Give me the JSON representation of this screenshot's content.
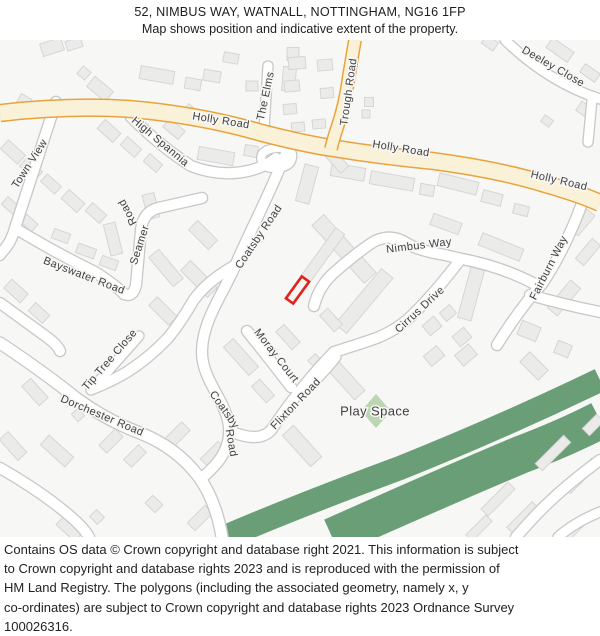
{
  "header": {
    "title": "52, NIMBUS WAY, WATNALL, NOTTINGHAM, NG16 1FP",
    "subtitle": "Map shows position and indicative extent of the property."
  },
  "footer": {
    "lines": [
      "Contains OS data © Crown copyright and database right 2021. This information is subject",
      "to Crown copyright and database rights 2023 and is reproduced with the permission of",
      "HM Land Registry. The polygons (including the associated geometry, namely x, y",
      "co-ordinates) are subject to Crown copyright and database rights 2023 Ordnance Survey",
      "100026316."
    ]
  },
  "map": {
    "colors": {
      "background": "#f7f7f6",
      "building_fill": "#ebebea",
      "building_stroke": "#d7d6d4",
      "road_casing": "#c8c8c6",
      "road_fill": "#ffffff",
      "main_road_casing": "#e8a33c",
      "main_road_fill": "#faf2d8",
      "green": "#699e77",
      "play_space_fill": "#bcd5b3",
      "label_color": "#3f3f3f",
      "plot_red": "#e32219"
    },
    "green": {
      "ribbons": [
        {
          "d": "M 225,537 Q 300,505 400,468 Q 500,428 600,380",
          "width": 24
        },
        {
          "d": "M 332,537 Q 430,493 520,455 Q 565,438 600,420",
          "width": 38
        }
      ],
      "play_space": {
        "label": "Play Space",
        "cx": 376,
        "cy": 411,
        "rx": 15,
        "ry": 17
      }
    },
    "white_roads": [
      {
        "name": "town-view",
        "d": "M 56,102 L 15,228 Q 11,243 2,252 L 0,255",
        "w": 10
      },
      {
        "name": "bayswater-road",
        "d": "M 18,230 Q 60,255 95,272 Q 118,287 124,294",
        "w": 10
      },
      {
        "name": "seamer-road",
        "d": "M 124,294 Q 133,298 136,285 L 141,230 Q 143,212 158,208 L 202,198",
        "w": 10
      },
      {
        "name": "coatsby-road",
        "d": "M 291,141 C 272,190 249,233 235,266 C 223,294 203,320 202,350 C 201,380 226,399 229,427 C 231,453 213,468 202,478",
        "w": 10
      },
      {
        "name": "the-elms",
        "d": "M 268,66 L 264,129",
        "w": 9
      },
      {
        "name": "deeley-close",
        "d": "M 505,40 Q 548,82 600,99",
        "w": 9
      },
      {
        "name": "deeley-spur",
        "d": "M 592,100 L 588,142",
        "w": 9
      },
      {
        "name": "fairburn-way",
        "d": "M 584,198 Q 566,248 542,284 Q 520,308 497,345",
        "w": 10
      },
      {
        "name": "fairburn-east",
        "d": "M 530,295 Q 565,305 600,312",
        "w": 10
      },
      {
        "name": "nimbus-way",
        "d": "M 314,306 Q 319,285 336,271 Q 360,250 375,241 Q 392,233 408,244 Q 420,251 445,255 L 462,259 Q 500,266 535,284",
        "w": 10
      },
      {
        "name": "cirrus-drive",
        "d": "M 460,260 Q 432,297 406,321 Q 388,335 368,341 Q 350,347 334,352",
        "w": 10
      },
      {
        "name": "flixton-road",
        "d": "M 334,352 Q 310,377 292,401 Q 280,417 272,429 Q 260,444 230,431",
        "w": 10
      },
      {
        "name": "moray-court",
        "d": "M 247,331 Q 272,362 291,387",
        "w": 10
      },
      {
        "name": "moray-stub",
        "d": "M 298,396 Q 320,378 336,357",
        "w": 9
      },
      {
        "name": "dorchester-road",
        "d": "M 0,343 Q 45,373 76,398 Q 106,420 140,433 Q 176,447 199,477 Q 216,501 222,537",
        "w": 11
      },
      {
        "name": "tip-tree-close",
        "d": "M 91,390 L 139,336",
        "w": 9
      },
      {
        "name": "mid-connector",
        "d": "M 234,266 Q 206,282 193,301 Q 181,322 168,338 Q 149,358 127,372 Q 110,382 92,389",
        "w": 10
      },
      {
        "name": "high-spannia",
        "d": "M 131,117 Q 160,146 191,166 Q 222,178 252,170 Q 268,165 276,158",
        "w": 10
      },
      {
        "name": "spannia-loop",
        "d": "M 262,162 Q 258,150 276,148 Q 294,147 292,158 Q 290,168 274,168 Q 264,168 262,162 Z",
        "w": 8
      },
      {
        "name": "sw-spur",
        "d": "M 0,303 L 44,335 Q 57,344 60,351",
        "w": 10
      },
      {
        "name": "sw-road",
        "d": "M 0,468 Q 42,492 70,516 Q 84,528 89,537",
        "w": 10
      },
      {
        "name": "br-road",
        "d": "M 600,460 Q 562,488 537,514 Q 523,529 516,537",
        "w": 10
      },
      {
        "name": "br-spur",
        "d": "M 600,512 Q 575,522 558,537",
        "w": 9
      }
    ],
    "yellow_roads": [
      {
        "name": "holly-road",
        "d": "M 0,113 Q 70,105 130,109 Q 200,115 262,133 Q 305,144 332,148 Q 380,156 433,161 Q 500,170 545,184 Q 580,194 600,203",
        "w": 15.5,
        "cw": 18.5
      },
      {
        "name": "trough-road",
        "d": "M 355,40 L 349,75 Q 345,105 337,128 Q 333,140 331,149",
        "w": 11,
        "cw": 14
      }
    ],
    "buildings": [
      [
        52,
        47,
        22,
        13,
        -18
      ],
      [
        74,
        44,
        16,
        10,
        -18
      ],
      [
        100,
        89,
        24,
        13,
        40
      ],
      [
        84,
        73,
        10,
        10,
        40
      ],
      [
        157,
        75,
        34,
        13,
        10
      ],
      [
        193,
        84,
        16,
        11,
        10
      ],
      [
        212,
        76,
        17,
        11,
        10
      ],
      [
        231,
        58,
        15,
        10,
        10
      ],
      [
        252,
        86,
        12,
        10,
        0
      ],
      [
        289,
        79,
        13,
        24,
        5
      ],
      [
        293,
        54,
        12,
        13,
        0
      ],
      [
        23,
        103,
        12,
        15,
        30
      ],
      [
        8,
        112,
        8,
        11,
        30
      ],
      [
        297,
        63,
        17,
        12,
        -5
      ],
      [
        292,
        86,
        15,
        11,
        -5
      ],
      [
        290,
        109,
        13,
        10,
        -5
      ],
      [
        298,
        127,
        13,
        9,
        -5
      ],
      [
        325,
        65,
        15,
        11,
        -5
      ],
      [
        327,
        93,
        13,
        10,
        -5
      ],
      [
        319,
        124,
        13,
        9,
        -5
      ],
      [
        369,
        102,
        9,
        9,
        0
      ],
      [
        366,
        114,
        8,
        8,
        0
      ],
      [
        560,
        50,
        26,
        12,
        35
      ],
      [
        590,
        73,
        18,
        10,
        35
      ],
      [
        490,
        43,
        14,
        10,
        35
      ],
      [
        585,
        110,
        15,
        11,
        35
      ],
      [
        547,
        121,
        10,
        8,
        35
      ],
      [
        348,
        172,
        34,
        13,
        10
      ],
      [
        392,
        181,
        44,
        13,
        10
      ],
      [
        427,
        190,
        14,
        11,
        10
      ],
      [
        458,
        184,
        40,
        13,
        14
      ],
      [
        492,
        198,
        20,
        12,
        14
      ],
      [
        521,
        210,
        15,
        10,
        14
      ],
      [
        582,
        222,
        26,
        12,
        -50
      ],
      [
        13,
        152,
        23,
        12,
        42
      ],
      [
        31,
        169,
        21,
        11,
        42
      ],
      [
        51,
        184,
        19,
        10,
        42
      ],
      [
        11,
        206,
        17,
        10,
        42
      ],
      [
        29,
        223,
        15,
        10,
        42
      ],
      [
        109,
        131,
        21,
        12,
        42
      ],
      [
        131,
        147,
        19,
        11,
        42
      ],
      [
        153,
        163,
        17,
        10,
        42
      ],
      [
        174,
        129,
        20,
        11,
        40
      ],
      [
        192,
        113,
        17,
        10,
        40
      ],
      [
        216,
        156,
        36,
        13,
        10
      ],
      [
        251,
        151,
        13,
        11,
        10
      ],
      [
        73,
        201,
        21,
        12,
        42
      ],
      [
        96,
        213,
        19,
        11,
        42
      ],
      [
        61,
        236,
        17,
        10,
        20
      ],
      [
        86,
        251,
        19,
        10,
        20
      ],
      [
        109,
        263,
        17,
        10,
        20
      ],
      [
        16,
        291,
        22,
        12,
        42
      ],
      [
        39,
        313,
        19,
        11,
        42
      ],
      [
        113,
        239,
        12,
        32,
        -14
      ],
      [
        151,
        206,
        12,
        25,
        -14
      ],
      [
        166,
        268,
        38,
        13,
        50
      ],
      [
        199,
        279,
        38,
        14,
        45
      ],
      [
        163,
        311,
        28,
        12,
        45
      ],
      [
        203,
        235,
        28,
        13,
        45
      ],
      [
        344,
        249,
        78,
        16,
        48
      ],
      [
        307,
        184,
        14,
        38,
        15
      ],
      [
        315,
        266,
        11,
        86,
        36
      ],
      [
        364,
        301,
        15,
        72,
        40
      ],
      [
        336,
        160,
        26,
        11,
        48
      ],
      [
        446,
        224,
        30,
        12,
        20
      ],
      [
        501,
        247,
        44,
        13,
        22
      ],
      [
        564,
        298,
        36,
        13,
        -50
      ],
      [
        588,
        252,
        26,
        11,
        -50
      ],
      [
        471,
        294,
        14,
        52,
        15
      ],
      [
        432,
        326,
        15,
        13,
        -40
      ],
      [
        448,
        313,
        13,
        11,
        -40
      ],
      [
        462,
        337,
        15,
        13,
        -40
      ],
      [
        434,
        356,
        17,
        13,
        -40
      ],
      [
        466,
        355,
        18,
        14,
        -40
      ],
      [
        529,
        331,
        20,
        15,
        22
      ],
      [
        563,
        349,
        15,
        13,
        22
      ],
      [
        534,
        366,
        26,
        14,
        45
      ],
      [
        241,
        357,
        38,
        13,
        48
      ],
      [
        288,
        337,
        24,
        11,
        48
      ],
      [
        331,
        320,
        22,
        11,
        48
      ],
      [
        263,
        391,
        22,
        11,
        48
      ],
      [
        302,
        446,
        42,
        15,
        48
      ],
      [
        347,
        381,
        38,
        14,
        48
      ],
      [
        317,
        363,
        16,
        10,
        48
      ],
      [
        13,
        446,
        28,
        12,
        48
      ],
      [
        57,
        451,
        33,
        13,
        42
      ],
      [
        69,
        529,
        25,
        11,
        42
      ],
      [
        111,
        441,
        23,
        11,
        -45
      ],
      [
        135,
        456,
        21,
        11,
        -45
      ],
      [
        176,
        436,
        28,
        12,
        -45
      ],
      [
        213,
        454,
        25,
        11,
        -45
      ],
      [
        200,
        518,
        25,
        11,
        -45
      ],
      [
        154,
        504,
        14,
        11,
        45
      ],
      [
        97,
        517,
        11,
        10,
        45
      ],
      [
        35,
        392,
        26,
        12,
        48
      ],
      [
        78,
        415,
        10,
        9,
        48
      ],
      [
        553,
        453,
        40,
        10,
        -45
      ],
      [
        581,
        476,
        40,
        10,
        -45
      ],
      [
        498,
        499,
        38,
        10,
        -45
      ],
      [
        523,
        518,
        36,
        10,
        -45
      ],
      [
        572,
        531,
        30,
        9,
        -45
      ],
      [
        479,
        528,
        28,
        9,
        -45
      ],
      [
        593,
        425,
        20,
        10,
        -45
      ]
    ],
    "labels": [
      {
        "text": "Holly Road",
        "x": 221,
        "y": 121,
        "r": 9
      },
      {
        "text": "Holly Road",
        "x": 401,
        "y": 149,
        "r": 9
      },
      {
        "text": "Holly Road",
        "x": 559,
        "y": 181,
        "r": 13
      },
      {
        "text": "Trough Road",
        "x": 349,
        "y": 92,
        "r": -82
      },
      {
        "text": "The Elms",
        "x": 266,
        "y": 96,
        "r": -78
      },
      {
        "text": "Deeley Close",
        "x": 553,
        "y": 67,
        "r": 30
      },
      {
        "text": "Town View",
        "x": 30,
        "y": 164,
        "r": -57
      },
      {
        "text": "High Spannia",
        "x": 160,
        "y": 142,
        "r": 40
      },
      {
        "text": "Bayswater Road",
        "x": 84,
        "y": 276,
        "r": 21
      },
      {
        "text": "Seamer",
        "x": 140,
        "y": 245,
        "r": -72
      },
      {
        "text": "Road",
        "x": 128,
        "y": 212,
        "r": -118
      },
      {
        "text": "Coatsby Road",
        "x": 259,
        "y": 237,
        "r": -56
      },
      {
        "text": "Coatsby",
        "x": 224,
        "y": 410,
        "r": 55
      },
      {
        "text": "Road",
        "x": 231,
        "y": 443,
        "r": 80
      },
      {
        "text": "Nimbus Way",
        "x": 419,
        "y": 246,
        "r": -7
      },
      {
        "text": "Cirrus Drive",
        "x": 420,
        "y": 310,
        "r": -43
      },
      {
        "text": "Fairburn Way",
        "x": 549,
        "y": 268,
        "r": -63
      },
      {
        "text": "Tip Tree Close",
        "x": 110,
        "y": 360,
        "r": -49
      },
      {
        "text": "Dorchester Road",
        "x": 102,
        "y": 416,
        "r": 23
      },
      {
        "text": "Moray Court",
        "x": 276,
        "y": 356,
        "r": 52
      },
      {
        "text": "Flixton Road",
        "x": 296,
        "y": 404,
        "r": -46
      },
      {
        "text": "Play Space",
        "x": 375,
        "y": 412,
        "r": 0,
        "size": 13
      }
    ],
    "plot": {
      "cx": 297.5,
      "cy": 290,
      "w": 9,
      "h": 27,
      "r": 36
    }
  }
}
